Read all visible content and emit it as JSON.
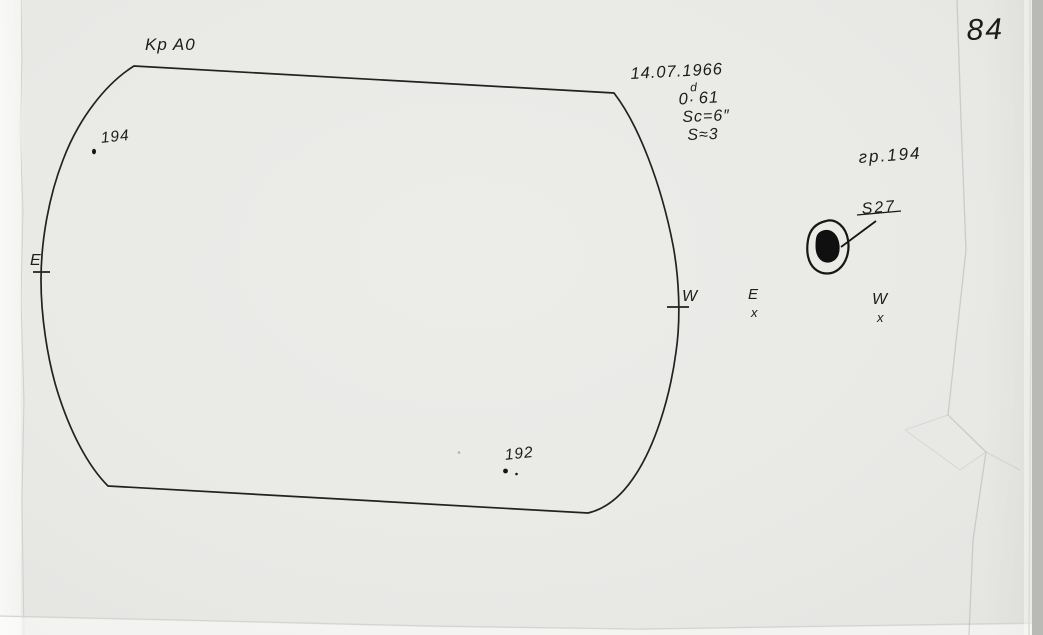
{
  "page": {
    "number": "84"
  },
  "title": {
    "observatory_code": "Kp A0"
  },
  "observation": {
    "date": "14.07.1966",
    "day_fraction": {
      "whole": "0",
      "dot": ".",
      "sup": "d",
      "digits": "61"
    },
    "scale": "Sc=6″",
    "seeing": "S≈3"
  },
  "solar_disk": {
    "east_limb_label": "E",
    "west_limb_label": "W",
    "group_194_label": "194",
    "group_192_label": "192"
  },
  "detail_sketch": {
    "group_label": "гр.194",
    "spot_label": "S27",
    "east_label": "E",
    "east_mark": "x",
    "west_label": "W",
    "west_mark": "x"
  },
  "colors": {
    "ink": "#1c1c1c",
    "paper": "#e9e9e6"
  }
}
